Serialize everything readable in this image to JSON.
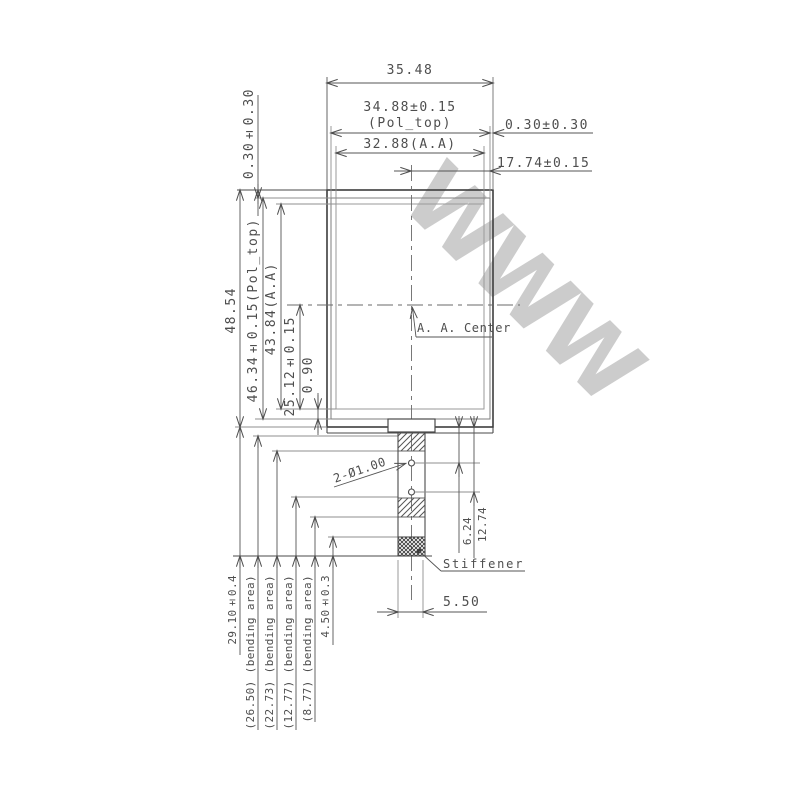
{
  "labels": {
    "watermark": "WWW",
    "top": {
      "overall_width": "35.48",
      "pol_width": "34.88±0.15",
      "pol_width_note": "(Pol_top)",
      "aa_width": "32.88(A.A)",
      "right_edge_offset": "0.30±0.30",
      "half_width": "17.74±0.15"
    },
    "left": {
      "top_edge_offset": "0.30±0.30",
      "overall_height": "48.54",
      "pol_height": "46.34±0.15(Pol_top)",
      "aa_height": "43.84(A.A)",
      "center_to_aa_bottom": "25.12±0.15",
      "aa_to_pol_gap": "0.90"
    },
    "center": {
      "aa_center": "A. A. Center"
    },
    "fpc": {
      "hole_callout": "2-Ø1.00",
      "hole1_offset": "6.24",
      "hole2_offset": "12.74",
      "stiffener": "Stiffener",
      "fpc_width": "5.50"
    },
    "bending": [
      "29.10±0.4",
      "(26.50) (bending area)",
      "(22.73) (bending area)",
      "(12.77) (bending area)",
      "(8.77) (bending area)",
      "4.50±0.3"
    ]
  }
}
